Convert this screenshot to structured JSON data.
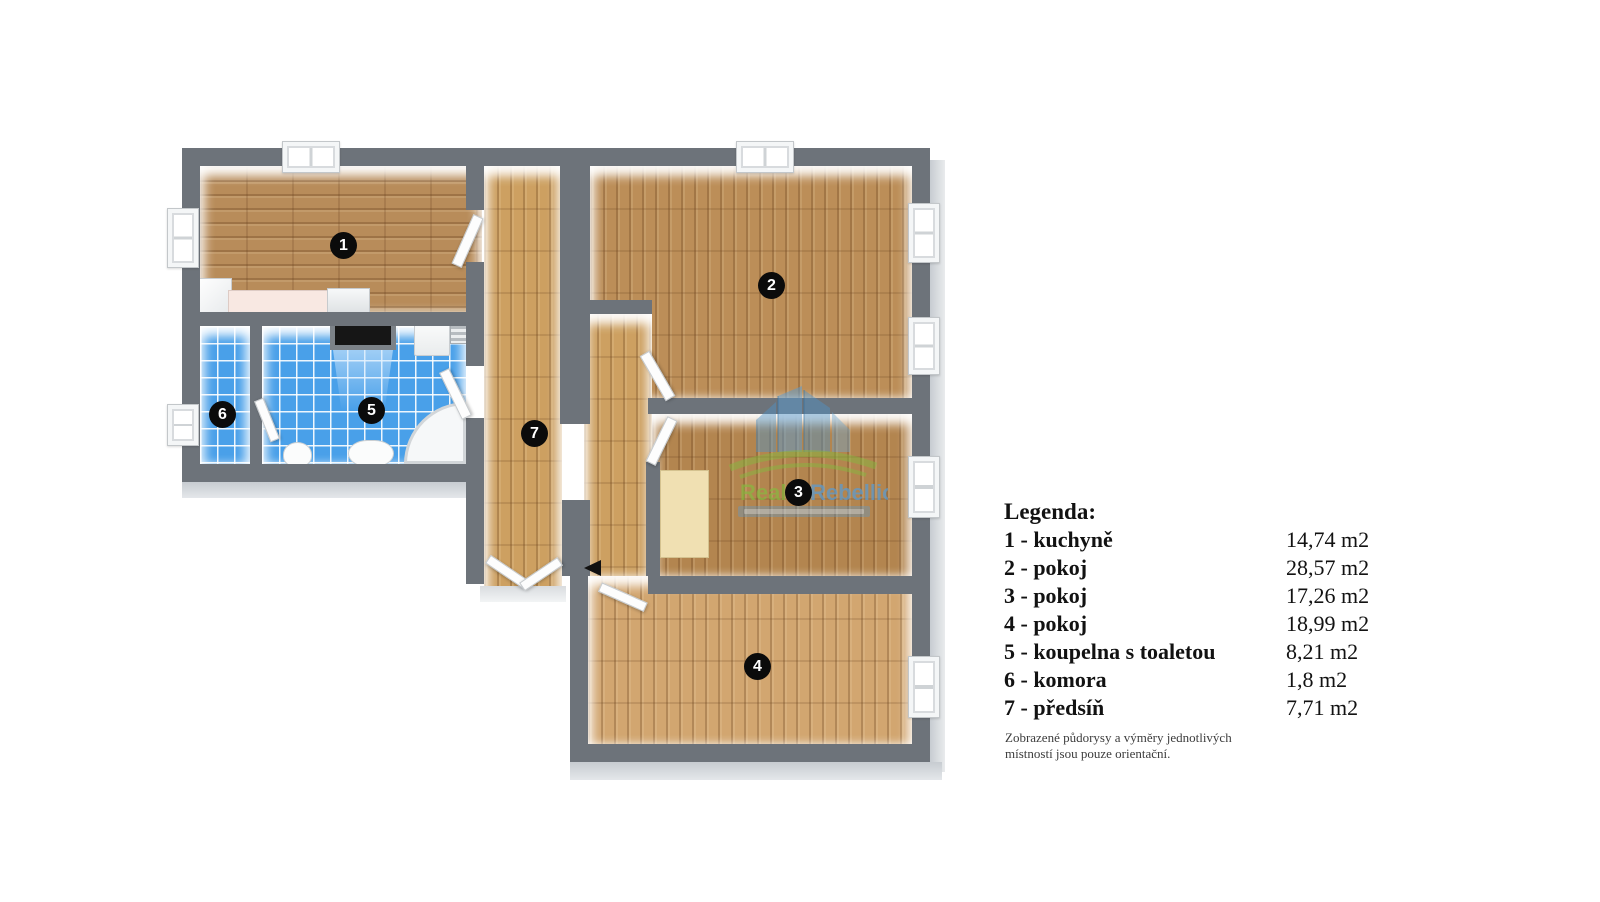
{
  "legend": {
    "title": "Legenda:",
    "items": [
      {
        "label": "1 - kuchyně",
        "area": "14,74 m2"
      },
      {
        "label": "2 - pokoj",
        "area": "28,57 m2"
      },
      {
        "label": "3 - pokoj",
        "area": "17,26 m2"
      },
      {
        "label": "4 - pokoj",
        "area": "18,99 m2"
      },
      {
        "label": "5 - koupelna s toaletou",
        "area": "8,21 m2"
      },
      {
        "label": "6 - komora",
        "area": "1,8 m2"
      },
      {
        "label": "7 - předsíň",
        "area": "7,71 m2"
      }
    ],
    "disclaimer_line1": "Zobrazené půdorysy a výměry jednotlivých",
    "disclaimer_line2": "místností jsou pouze orientační."
  },
  "rooms": [
    {
      "num": "1",
      "name": "kuchyně"
    },
    {
      "num": "2",
      "name": "pokoj"
    },
    {
      "num": "3",
      "name": "pokoj"
    },
    {
      "num": "4",
      "name": "pokoj"
    },
    {
      "num": "5",
      "name": "koupelna s toaletou"
    },
    {
      "num": "6",
      "name": "komora"
    },
    {
      "num": "7",
      "name": "předsíň"
    }
  ],
  "watermark": {
    "word1": "Reality",
    "word2": "Rebellion"
  },
  "colors": {
    "wall": "#6d737a",
    "tile_blue": "#49a0e9",
    "wood_kitchen": "#b88c5a",
    "wood_room2": "#bc8e58",
    "wood_room3": "#b3854f",
    "wood_room4": "#d2a670",
    "wood_hall": "#cda061",
    "counter_pink": "#f8e8e2",
    "wm_green": "#86b93f",
    "wm_blue": "#5b9bd0"
  }
}
